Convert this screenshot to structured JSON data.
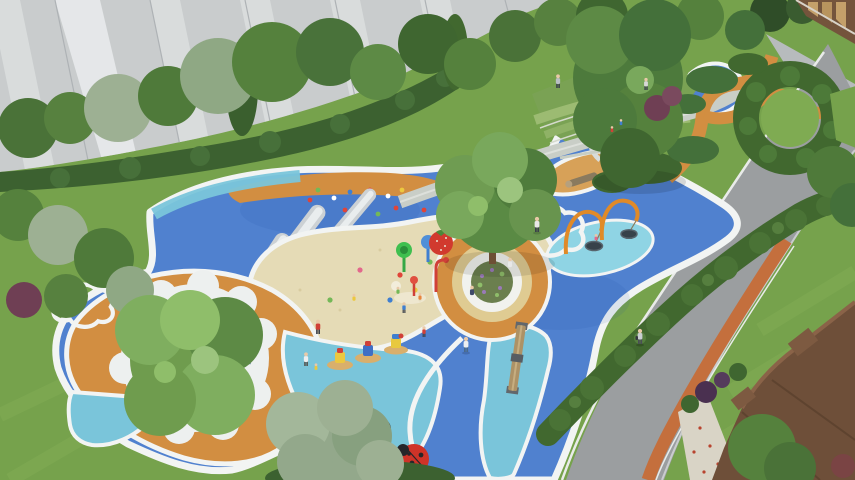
{
  "palette": {
    "facade_gray": "#c9cccd",
    "facade_stripe": "#e6e9ea",
    "lawn_green": "#76a24c",
    "lawn_light": "#8ab35c",
    "tree_green_dark": "#3f6630",
    "tree_green": "#55813d",
    "tree_green_light": "#7fae5f",
    "tree_gray_green": "#9db093",
    "hedge_green": "#41682f",
    "play_blue": "#5081cf",
    "play_cyan": "#7ac5da",
    "sand_beige": "#e5dbb6",
    "sand_tan": "#d7a158",
    "play_orange": "#d28e41",
    "ring_tan": "#dfcb92",
    "track_orange": "#c46f3d",
    "path_gray": "#c9cec7",
    "road_gray": "#9b9ea0",
    "edge_white": "#f2f4f3",
    "slide_silver": "#ccd1d4",
    "roof_brown": "#6e4f39",
    "clubhouse_brown": "#74543c",
    "ladybug_red": "#cf3328",
    "accent_red": "#e04438",
    "accent_yellow": "#ecc83f",
    "accent_green": "#74b857",
    "accent_blue": "#3f7fd0",
    "accent_pink": "#e2688c",
    "swing_orange": "#e08a28"
  },
  "scene": {
    "view": "aerial perspective rendering",
    "setting": "residential courtyard children's playground",
    "areas": [
      {
        "name": "apartment-facade",
        "desc": "gray paneled high-rise facade, top left"
      },
      {
        "name": "tree-belt",
        "desc": "dense trees and shrubs along top and left"
      },
      {
        "name": "playground-surface",
        "desc": "organic blue rubber surface with white edging"
      },
      {
        "name": "sand-pit",
        "desc": "large beige sand play area with toys and children"
      },
      {
        "name": "climbing-slope",
        "desc": "blue mound with colored holds and three steel slides"
      },
      {
        "name": "rainbow-slide",
        "desc": "striped hill slide, upper right"
      },
      {
        "name": "tree-ring-bench",
        "desc": "central tree with white ring bench inside orange ring"
      },
      {
        "name": "water-play",
        "desc": "colorful spray posts"
      },
      {
        "name": "nest-swings",
        "desc": "two orange arch swings with basket seats"
      },
      {
        "name": "balance-beam",
        "desc": "timber beam on cyan strip"
      },
      {
        "name": "ride-on-toys",
        "desc": "three colorful spring riders on round mats"
      },
      {
        "name": "ladybug-sculptures",
        "desc": "red and dark beetle play sculptures"
      },
      {
        "name": "berry-sculpture",
        "desc": "red berry sculpture beside tree ring"
      },
      {
        "name": "sun-motif",
        "desc": "white cloud inlay with ray pattern on orange ground"
      },
      {
        "name": "cloud-motif",
        "desc": "white cloud outlines on blue surface"
      },
      {
        "name": "terraced-lawn",
        "desc": "stepped grass terraces, top center"
      },
      {
        "name": "hedge-garden",
        "desc": "rounded hedges and C-shaped hedge ring, right"
      },
      {
        "name": "walkways",
        "desc": "gray footpath and winding orange path"
      },
      {
        "name": "road",
        "desc": "asphalt drive with orange jogging lane, right"
      },
      {
        "name": "clubhouse",
        "desc": "wood-clad entrance building, top right"
      },
      {
        "name": "residence-roof",
        "desc": "brown building roof, bottom right"
      },
      {
        "name": "people",
        "desc": "about 15 residents and children"
      }
    ]
  }
}
